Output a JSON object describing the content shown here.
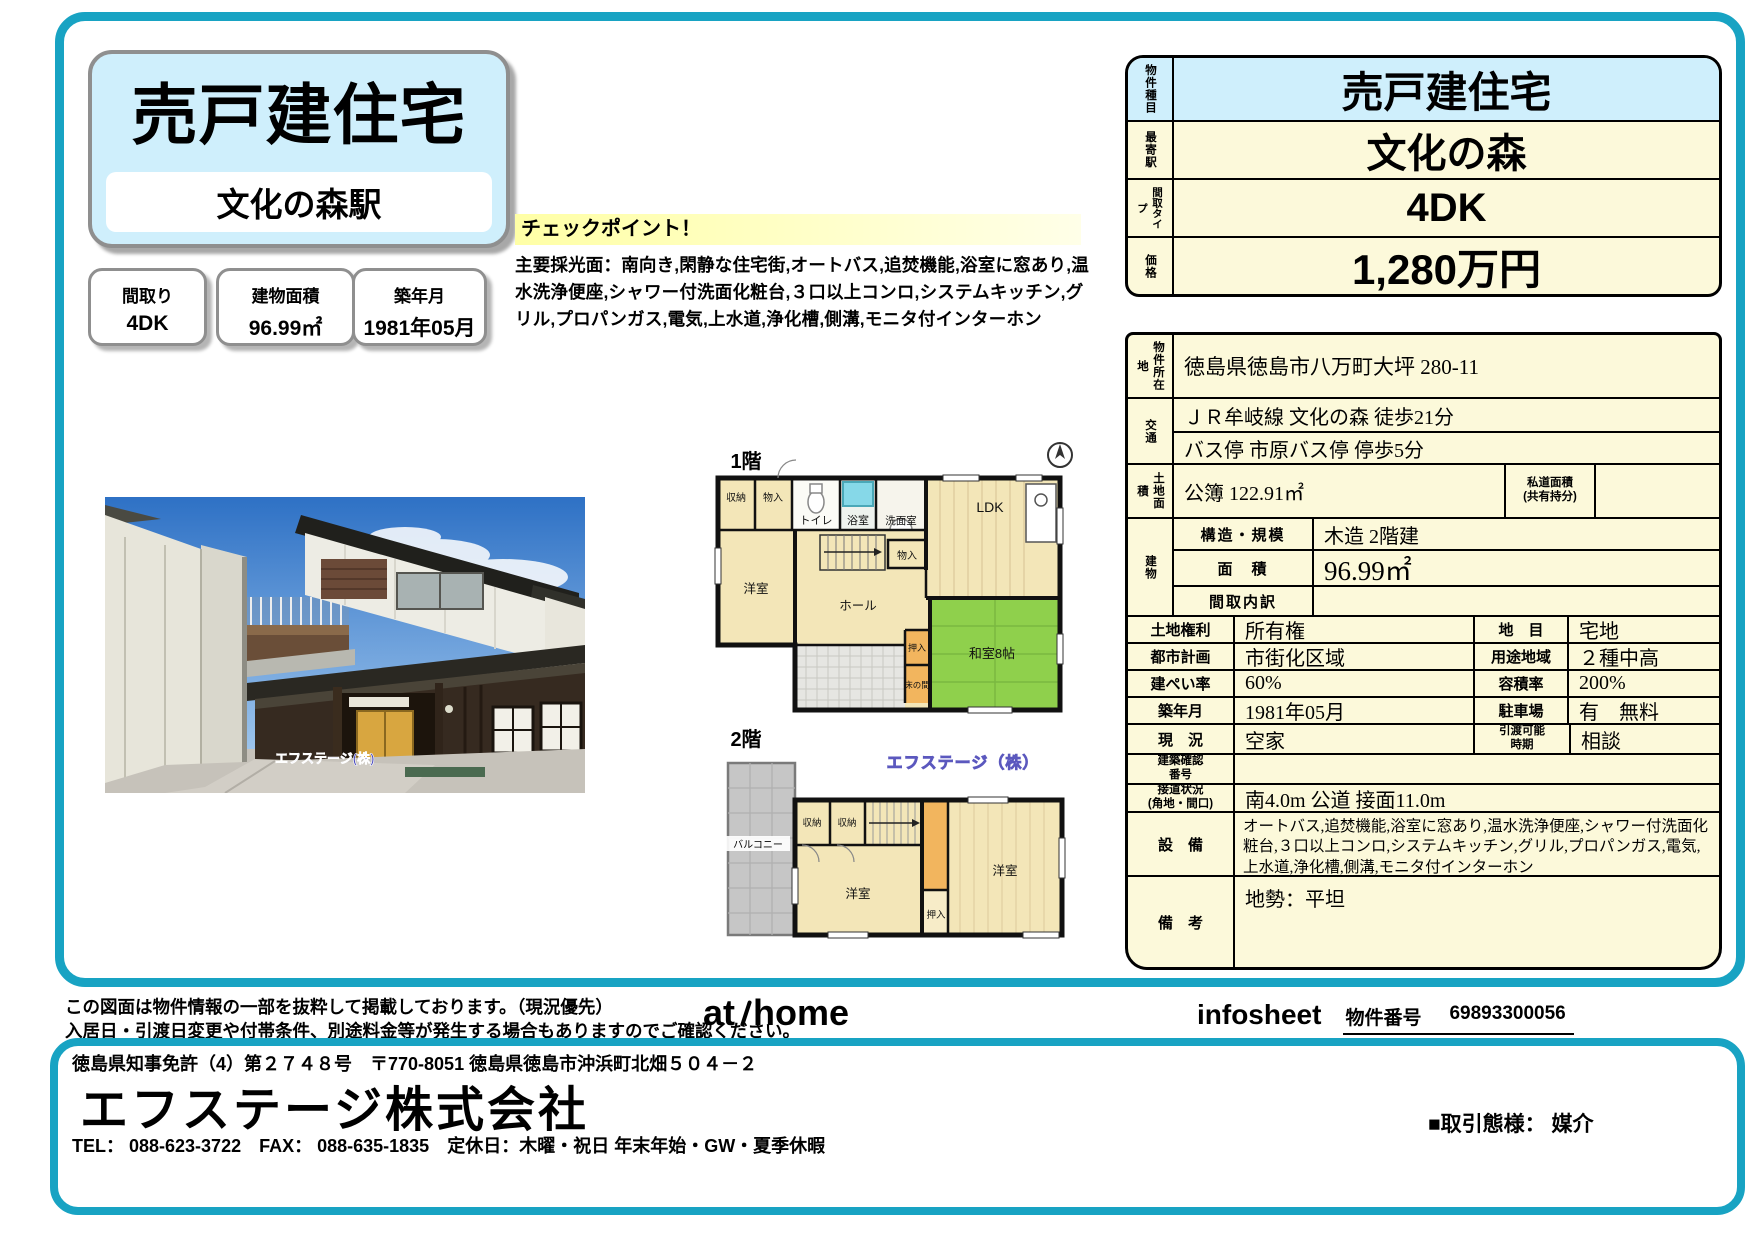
{
  "colors": {
    "frame_teal": "#18a3c3",
    "brand_bg": "#cfeffc",
    "table_cream": "#fcf9da",
    "checkpoint_yellow": "#ffffa6",
    "tatami_green": "#8fd04c",
    "plan_cream": "#f3e6b8",
    "watermark_blue": "#5b57c8"
  },
  "header": {
    "title": "売戸建住宅",
    "station": "文化の森駅"
  },
  "spec_boxes": [
    {
      "label": "間取り",
      "value": "4DK"
    },
    {
      "label": "建物面積",
      "value": "96.99㎡"
    },
    {
      "label": "築年月",
      "value": "1981年05月"
    }
  ],
  "checkpoint": {
    "title": "チェックポイント！",
    "body": "主要採光面：南向き,閑静な住宅街,オートバス,追焚機能,浴室に窓あり,温水洗浄便座,シャワー付洗面化粧台,３口以上コンロ,システムキッチン,グリル,プロパンガス,電気,上水道,浄化槽,側溝,モニタ付インターホン"
  },
  "photo": {
    "watermark": "エフステージ(株)"
  },
  "floorplan": {
    "watermark": "エフステージ（株）",
    "f1": {
      "label": "1階",
      "rooms": {
        "shuno": "収納",
        "mono1": "物入",
        "toilet": "トイレ",
        "bath": "浴室",
        "senmen": "洗面室",
        "yoshitsu": "洋室",
        "mono2": "物入",
        "ldk": "LDK",
        "hall": "ホール",
        "oshiire": "押入",
        "washitsu": "和室8帖",
        "tokonoma": "床の間"
      }
    },
    "f2": {
      "label": "2階",
      "rooms": {
        "balcony": "バルコニー",
        "shuno1": "収納",
        "shuno2": "収納",
        "yoshitsu1": "洋室",
        "oshiire": "押入",
        "yoshitsu2": "洋室"
      }
    }
  },
  "summary": {
    "rows": [
      {
        "label": "物件種目",
        "value": "売戸建住宅"
      },
      {
        "label": "最寄駅",
        "value": "文化の森"
      },
      {
        "label": "間取タイプ",
        "value": "4DK"
      },
      {
        "label": "価格",
        "value": "1,280万円"
      }
    ]
  },
  "detail": {
    "location_label": "物件所在地",
    "location": "徳島県徳島市八万町大坪 280-11",
    "access_label": "交通",
    "access1": "ＪＲ牟岐線 文化の森 徒歩21分",
    "access2": "バス停 市原バス停 停歩5分",
    "land_label": "土地面積",
    "land": "公簿 122.91㎡",
    "private_road_label": "私道面積\n(共有持分)",
    "private_road": "",
    "building_label": "建物",
    "structure_label": "構造・規模",
    "structure": "木造 2階建",
    "area_label": "面　積",
    "area": "96.99㎡",
    "layout_label": "間取内訳",
    "layout": "",
    "pairs": [
      {
        "l1": "土地権利",
        "v1": "所有権",
        "l2": "地　目",
        "v2": "宅地"
      },
      {
        "l1": "都市計画",
        "v1": "市街化区域",
        "l2": "用途地域",
        "v2": "２種中高"
      },
      {
        "l1": "建ぺい率",
        "v1": "60%",
        "l2": "容積率",
        "v2": "200%"
      },
      {
        "l1": "築年月",
        "v1": "1981年05月",
        "l2": "駐車場",
        "v2": "有　無料"
      },
      {
        "l1": "現　況",
        "v1": "空家",
        "l2": "引渡可能\n時期",
        "v2": "相談"
      }
    ],
    "confirm_label": "建築確認\n番号",
    "confirm": "",
    "road_label": "接道状況\n(角地・間口)",
    "road": "南4.0m 公道 接面11.0m",
    "equip_label": "設　備",
    "equip": "オートバス,追焚機能,浴室に窓あり,温水洗浄便座,シャワー付洗面化粧台,３口以上コンロ,システムキッチン,グリル,プロパンガス,電気,上水道,浄化槽,側溝,モニタ付インターホン",
    "notes_label": "備　考",
    "notes": "地勢：平坦"
  },
  "footer": {
    "disclaimer1": "この図面は物件情報の一部を抜粋して掲載しております。（現況優先）",
    "disclaimer2": "入居日・引渡日変更や付帯条件、別途料金等が発生する場合もありますのでご確認ください。",
    "logo_at": "at",
    "logo_home": "home",
    "infosheet": "infosheet",
    "property_no_label": "物件番号",
    "property_no": "69893300056"
  },
  "company": {
    "license": "徳島県知事免許（4）第２７４８号　〒770-8051 徳島県徳島市沖浜町北畑５０４－２",
    "name": "エフステージ株式会社",
    "contact": "TEL： 088-623-3722　FAX： 088-635-1835　定休日：木曜・祝日 年末年始・GW・夏季休暇",
    "deal_type": "■取引態様： 媒介"
  }
}
